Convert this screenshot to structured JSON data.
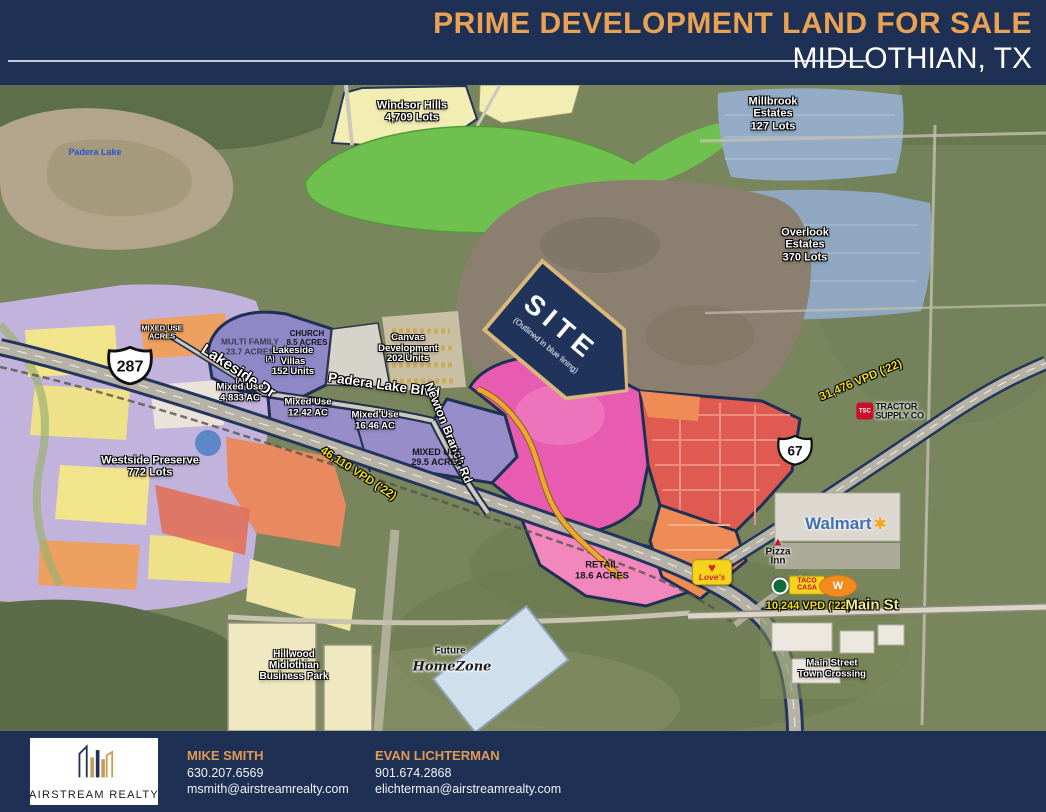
{
  "header": {
    "title": "PRIME DEVELOPMENT LAND FOR SALE",
    "subtitle": "MIDLOTHIAN, TX"
  },
  "map": {
    "site_banner": {
      "title": "SITE",
      "note": "(Outlined in blue lining)"
    },
    "shields": {
      "us287": "287",
      "us67": "67"
    },
    "traffic": {
      "vpd_287": "46,110 VPD ('22)",
      "vpd_67": "31,476 VPD ('22)",
      "vpd_main": "10,244 VPD ('22)"
    },
    "roads": {
      "lakeside_dr": "Lakeside Dr",
      "padera_lake_blvd": "Padera Lake Blvd",
      "newton_branch_rd": "Newton Branch Rd",
      "main_st": "Main St"
    },
    "labels": {
      "padera_lake": "Padera Lake",
      "windsor_hills": "Windsor Hills\n4,709 Lots",
      "millbrook": "Millbrook\nEstates\n127 Lots",
      "overlook": "Overlook\nEstates\n370 Lots",
      "mixed_use_small": "MIXED USE\nACRES",
      "multi_family": "MULTI FAMILY\n23.7 ACRES",
      "church": "CHURCH\n8.5 ACRES",
      "lakeside_villas": "Lakeside\nVillas\n152 Units",
      "canvas": "Canvas\nDevelopment\n202 Units",
      "marker_a": "(A)",
      "mixed_use_4833": "Mixed Use\n4.833 AC",
      "mixed_use_1242": "Mixed Use\n12.42 AC",
      "mixed_use_1646": "Mixed Use\n16.46 AC",
      "mixed_use_295": "MIXED USE\n29.5 ACRES",
      "westside": "Westside Preserve\n772 Lots",
      "retail": "RETAIL\n18.6 ACRES",
      "hillwood": "Hillwood\nMidlothian\nBusiness Park",
      "future": "Future",
      "main_street_crossing": "Main Street\nTown Crossing"
    },
    "logos": {
      "walmart": "Walmart",
      "loves": "Love's",
      "pizza_inn": "Pizza\nInn",
      "taco_casa": "TACO\nCASA",
      "whataburger_w": "W",
      "homezone": "HomeZone",
      "tsc_abbr": "TSC",
      "tractor_supply": "TRACTOR\nSUPPLY CO"
    },
    "icons": {
      "walmart_spark": "✱",
      "loves_heart": "♥",
      "pizza_inn_roof": "▲"
    }
  },
  "footer": {
    "company": "AIRSTREAM REALTY",
    "contacts": [
      {
        "name": "MIKE SMITH",
        "phone": "630.207.6569",
        "email": "msmith@airstreamrealty.com"
      },
      {
        "name": "EVAN LICHTERMAN",
        "phone": "901.674.2868",
        "email": "elichterman@airstreamrealty.com"
      }
    ]
  },
  "colors": {
    "header_navy": "#1e3054",
    "accent_orange": "#e09a54",
    "site_outline": "#1e3054",
    "vpd_yellow": "#f3df1b",
    "magenta_zone": "#e75cb0",
    "red_zone": "#df5a50"
  }
}
